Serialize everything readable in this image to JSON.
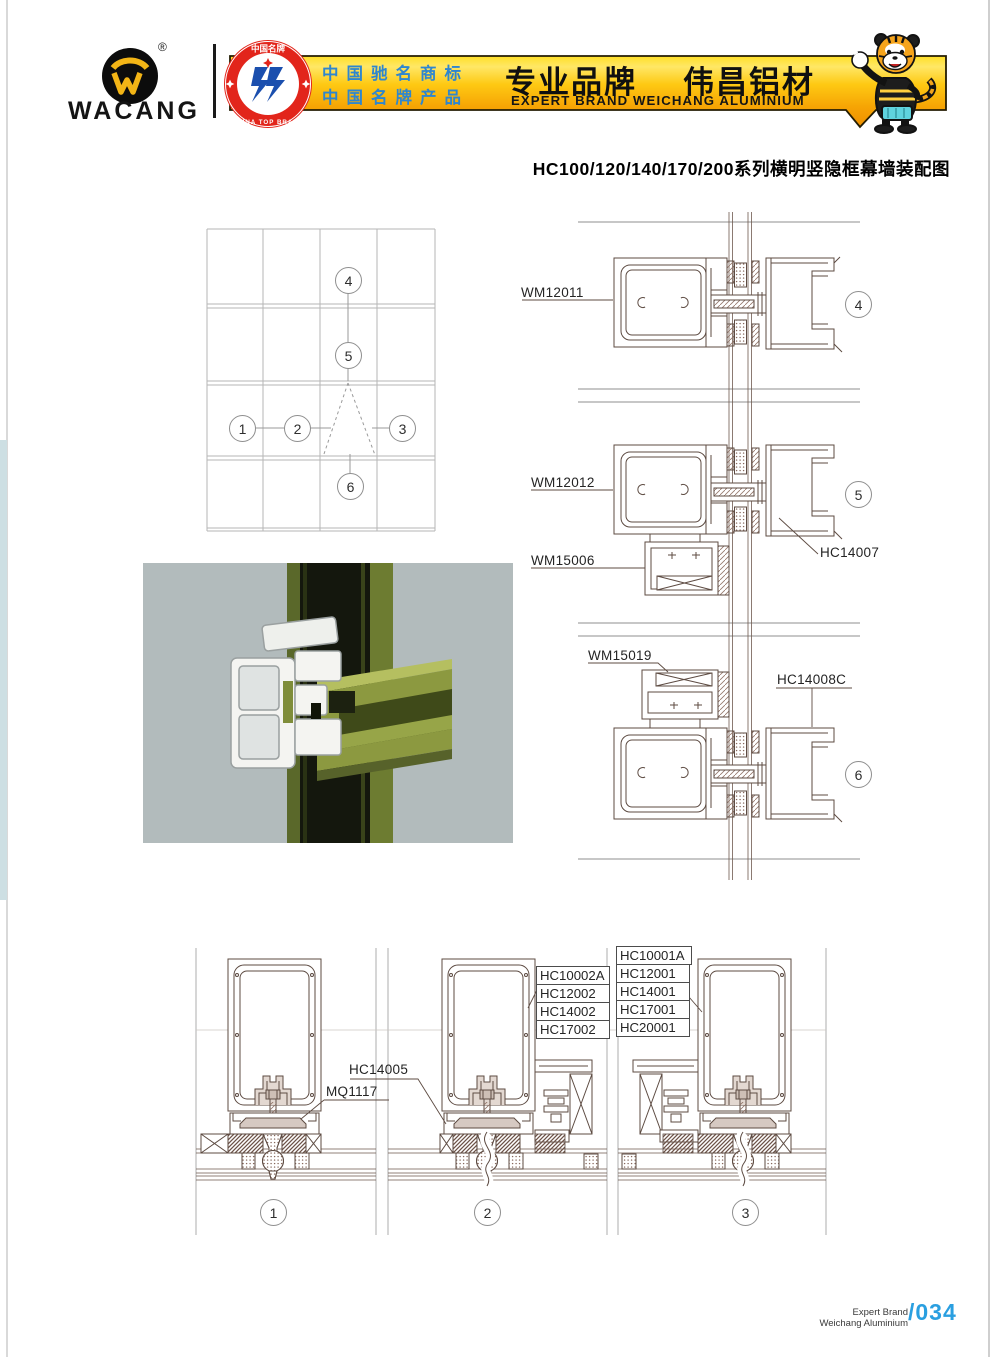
{
  "header": {
    "logo": {
      "text": "WACANG",
      "registered": "®"
    },
    "badge": {
      "top": "中国名牌",
      "bottom": "CHINA TOP BRAND"
    },
    "banner": {
      "honor_line1": "中国驰名商标",
      "honor_line2": "中国名牌产品",
      "brand_cn": "专业品牌",
      "name_cn": "伟昌铝材",
      "slogan_en": "EXPERT BRAND WEICHANG ALUMINIUM"
    }
  },
  "title": "HC100/120/140/170/200系列横明竖隐框幕墙装配图",
  "elevation": {
    "markers": [
      "1",
      "2",
      "3",
      "4",
      "5",
      "6"
    ]
  },
  "right_details": [
    {
      "id": "4",
      "label": "WM12011"
    },
    {
      "id": "5",
      "label_top": "WM12012",
      "label_bottom": "WM15006",
      "label_right": "HC14007"
    },
    {
      "id": "6",
      "label_left": "WM15019",
      "label_right": "HC14008C"
    }
  ],
  "bottom_details": [
    {
      "id": "1",
      "label_a": "HC14005",
      "label_b": "MQ1117"
    },
    {
      "id": "2",
      "stack": [
        "HC10002A",
        "HC12002",
        "HC14002",
        "HC17002"
      ]
    },
    {
      "id": "3",
      "stack": [
        "HC10001A",
        "HC12001",
        "HC14001",
        "HC17001",
        "HC20001"
      ]
    }
  ],
  "footer": {
    "line1": "Expert Brand",
    "line2": "Weichang Aluminium",
    "page": "/034"
  },
  "colors": {
    "banner_yellow": "#f6a404",
    "banner_text_blue": "#2e86cf",
    "badge_red": "#e2251b",
    "page_number_blue": "#2a9fe0",
    "drawing_stroke": "#5d4b42",
    "profile_green": "#8c9940"
  }
}
